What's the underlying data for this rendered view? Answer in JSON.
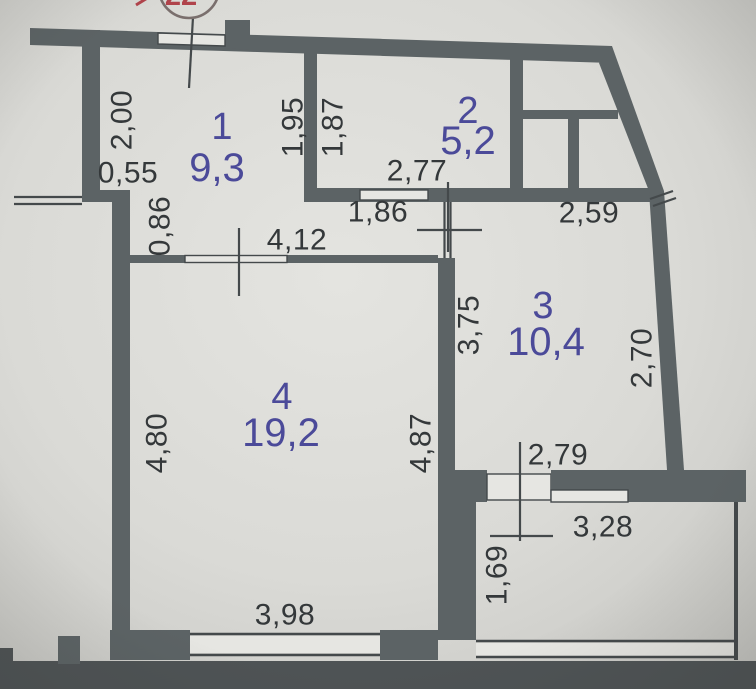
{
  "document": {
    "kind": "scanned apartment floor plan",
    "stamp": {
      "number": "22"
    }
  },
  "rooms": [
    {
      "id": "1",
      "area": "9,3"
    },
    {
      "id": "2",
      "area": "5,2"
    },
    {
      "id": "3",
      "area": "10,4"
    },
    {
      "id": "4",
      "area": "19,2"
    }
  ],
  "dims": {
    "room1_left_height": "2,00",
    "room1_step_width": "0,55",
    "hall_left_height": "0,86",
    "room1_right_height": "1,95",
    "room2_left_height": "1,87",
    "room2_width": "2,77",
    "hall_opening_width": "1,86",
    "right_span_width": "2,59",
    "room4_top_width": "4,12",
    "room3_left_height": "3,75",
    "room3_right_height": "2,70",
    "room4_left_height": "4,80",
    "room4_right_height": "4,87",
    "room3_bottom_width": "2,79",
    "balcony_top_width": "3,28",
    "balcony_left_height": "1,69",
    "room4_bottom_width": "3,98"
  },
  "colors": {
    "paper": "#dbdbd7",
    "paper_light": "#e6e6e2",
    "paper_dark": "#c6c6c2",
    "wall": "#5c6365",
    "line": "#44494b",
    "dim_text": "#34383a",
    "room_text": "#4b4a99",
    "stamp_red": "#b0434b",
    "stamp_ring": "#7a6f6d",
    "photo_edge": "#4e5355"
  }
}
